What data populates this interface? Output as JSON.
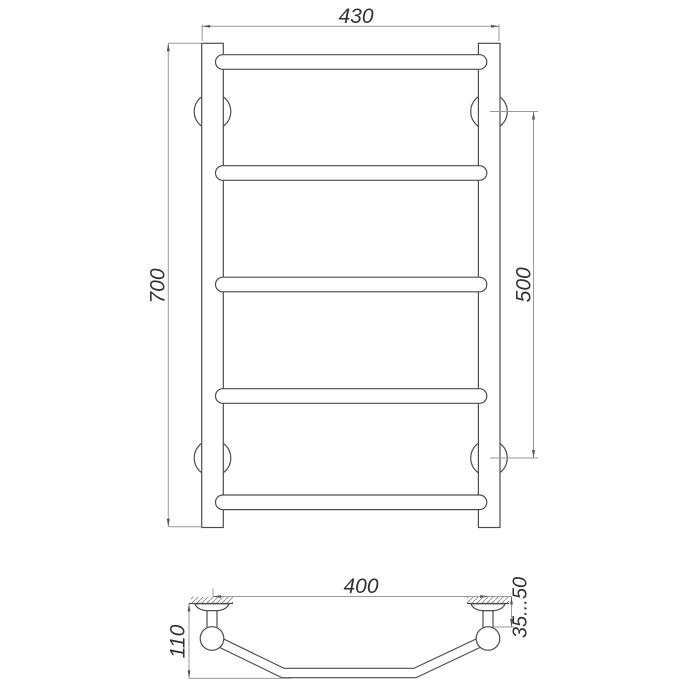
{
  "page": {
    "background": "#ffffff"
  },
  "style": {
    "object_line_color": "#4d4d4d",
    "dimension_line_color": "#9a9a9a",
    "hatch_color": "#8a8a8a",
    "label_color": "#333333",
    "page_background": "#ffffff"
  },
  "drawing": {
    "kind": "technical-dimension-drawing",
    "subject": "ladder-style towel rail, front elevation and bottom profile view"
  },
  "front_view": {
    "rails": 2,
    "rungs": 5,
    "wall_mounts": 4,
    "dimensions": {
      "overall_width": "430",
      "overall_height": "700",
      "mount_spacing": "500"
    }
  },
  "side_view": {
    "brackets": 2,
    "dimensions": {
      "bracket_span": "400",
      "depth": "110",
      "wall_clearance": "35...50"
    }
  }
}
